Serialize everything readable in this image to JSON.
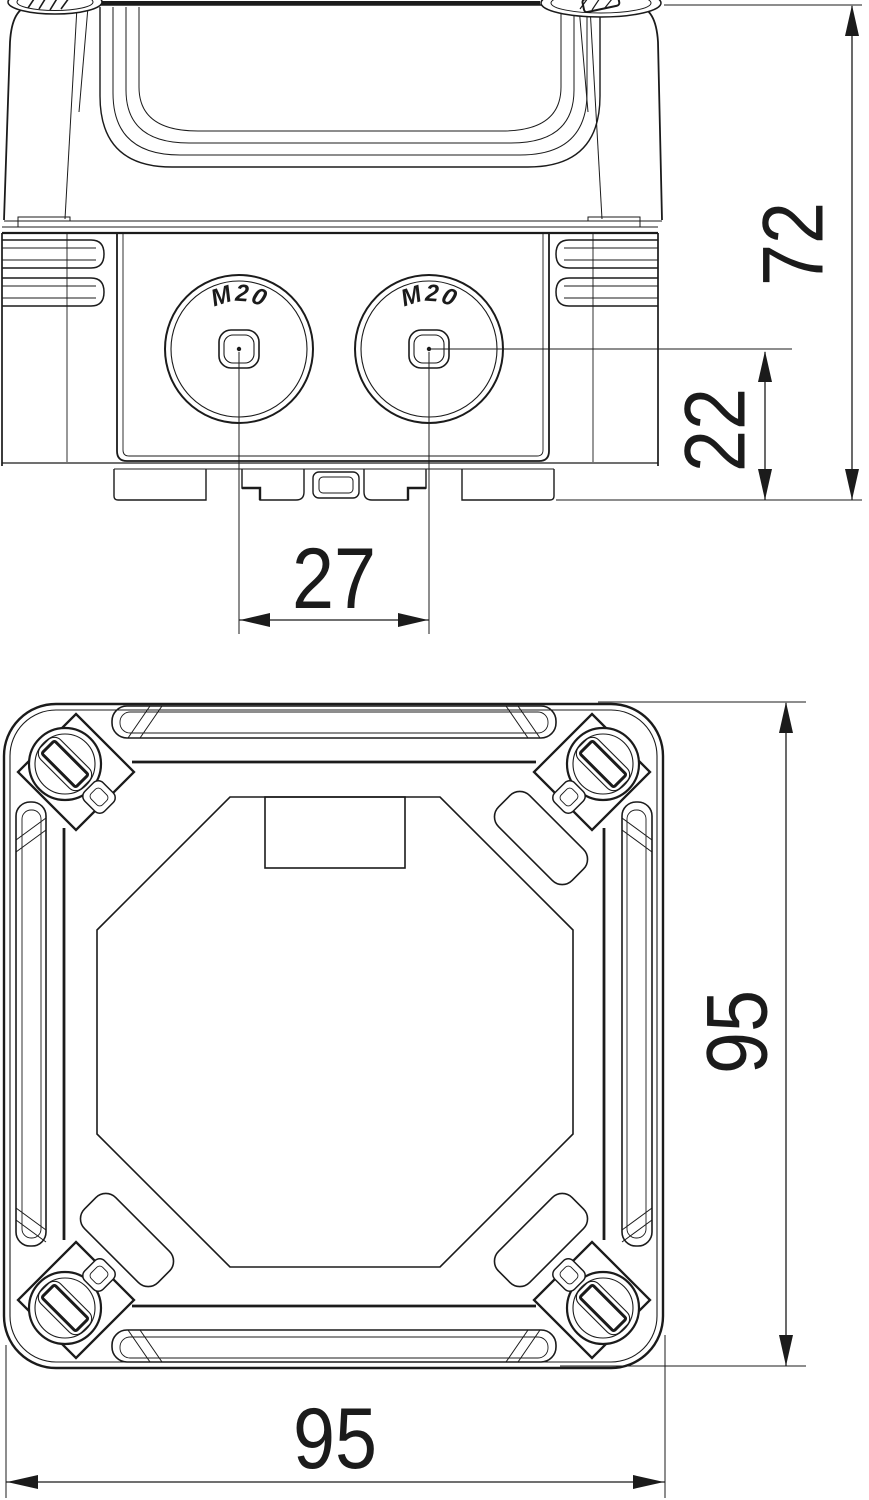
{
  "drawing": {
    "side_view": {
      "knockout_left_label": "M20",
      "knockout_right_label": "M20"
    },
    "dimensions": {
      "total_height": "72",
      "entry_center_height": "22",
      "entry_spacing": "27",
      "overall_height": "95",
      "overall_width": "95"
    }
  },
  "colors": {
    "line": "#1b1b1b",
    "background": "#ffffff"
  }
}
